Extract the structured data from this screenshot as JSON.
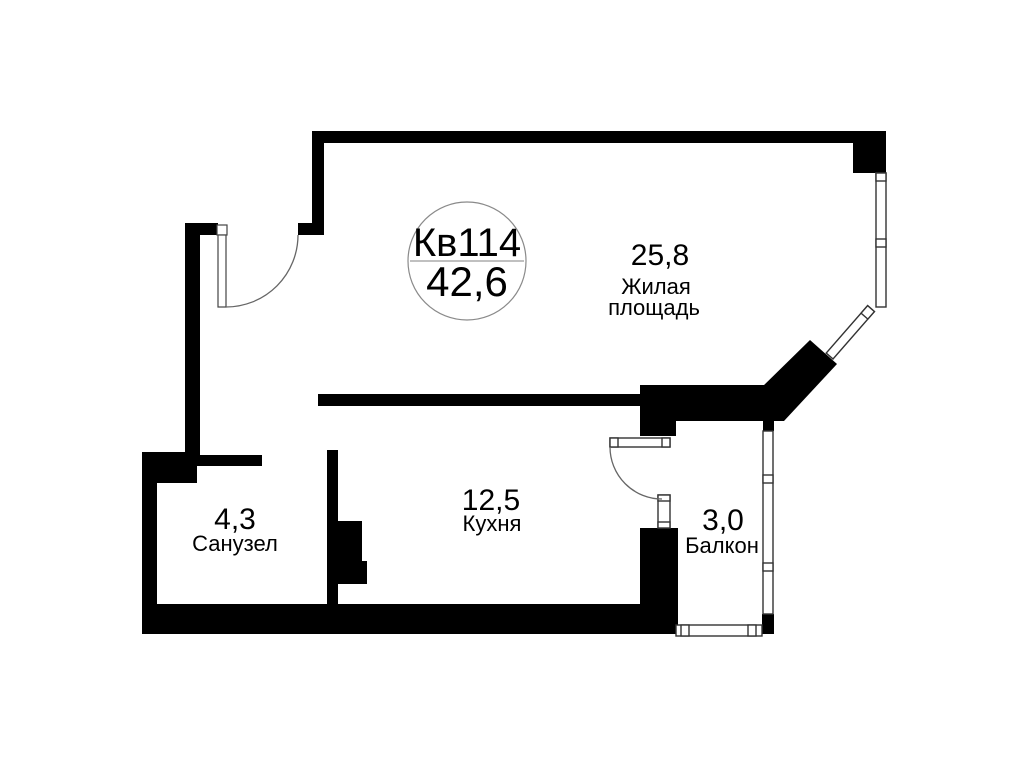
{
  "canvas": {
    "background": "#ffffff",
    "wall_color": "#000000",
    "outline_color": "#333333"
  },
  "badge": {
    "apartment_number": "Кв114",
    "total_area": "42,6"
  },
  "rooms": {
    "living": {
      "area": "25,8",
      "name_line1": "Жилая",
      "name_line2": "площадь"
    },
    "kitchen": {
      "area": "12,5",
      "name": "Кухня"
    },
    "bathroom": {
      "area": "4,3",
      "name": "Санузел"
    },
    "balcony": {
      "area": "3,0",
      "name": "Балкон"
    }
  }
}
